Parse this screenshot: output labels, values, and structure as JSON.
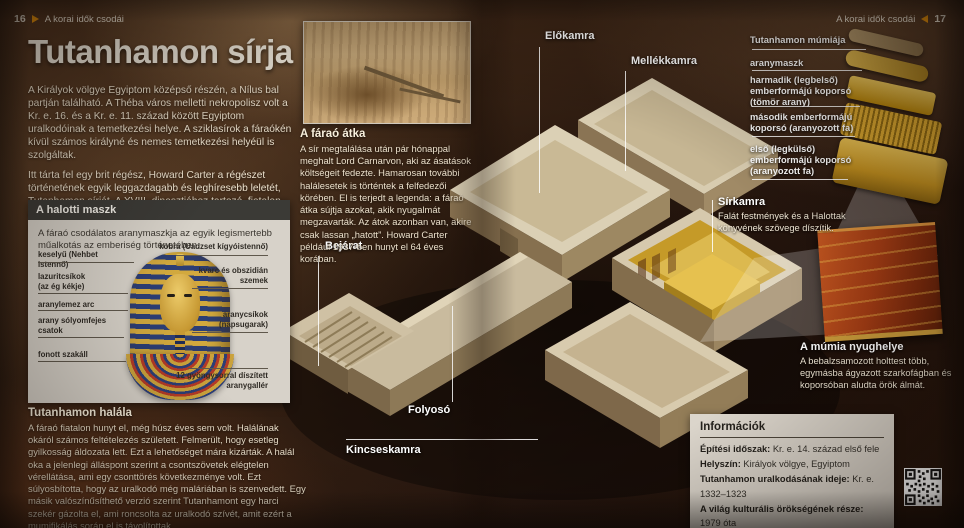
{
  "page": {
    "header_left": {
      "page_number": "16",
      "section_title": "A korai idők csodái"
    },
    "header_right": {
      "section_title": "A korai idők csodái",
      "page_number": "17"
    },
    "title": "Tutanhamon sírja",
    "intro_paragraphs": {
      "p1": "A Királyok völgye Egyiptom középső részén, a Nílus bal partján található. A Théba város melletti nekropolisz volt a Kr. e. 16. és a Kr. e. 11. század között Egyiptom uralkodóinak a temetkezési helye. A sziklasírok a fáraókén kívül számos királyné és nemes temetkezési helyéül is szolgáltak.",
      "p2": "Itt tárta fel egy brit régész, Howard Carter a régészet történetének egyik leggazdagabb és leghíresebb leletét, Tutanhamon sírját. A XVIII. dinasztiához tartozó, fiatalon elhunyt fáraó nyughelye máig az egyetlen, épségben megmaradt fáraósír."
    }
  },
  "mask_box": {
    "title": "A halotti maszk",
    "description": "A fáraó csodálatos aranymaszkja az egyik legismertebb műalkotás az emberiség történetében.",
    "labels": {
      "vulture": "keselyű (Nehbet istennő)",
      "lapis": "lazuritcsíkok (az ég kékje)",
      "gold_face": "aranylemez arc",
      "falcon_clasps": "arany sólyomfejes csatok",
      "braided_beard": "fonott szakáll",
      "cobra": "kobra (Uadzset kígyóistennő)",
      "eyes": "kvarc és obszidián szemek",
      "gold_stripes": "aranycsíkok (napsugarak)",
      "collar": "12 gyöngysorral díszített aranygallér"
    }
  },
  "death_section": {
    "title": "Tutanhamon halála",
    "text": "A fáraó fiatalon hunyt el, még húsz éves sem volt. Halálának okáról számos feltételezés született. Felmerült, hogy esetleg gyilkosság áldozata lett. Ezt a lehetőséget mára kizárták. A halál oka a jelenlegi álláspont szerint a csontszövetek elégtelen vérellátása, ami egy csonttörés következménye volt. Ezt súlyosbította, hogy az uralkodó még maláriában is szenvedett. Egy másik valószínűsíthető verzió szerint Tutanhamont egy harci szekér gázolta el, ami roncsolta az uralkodó szívét, amit ezért a mumifikálás során el is távolítottak."
  },
  "curse_section": {
    "title": "A fáraó átka",
    "text": "A sír megtalálása után pár hónappal meghalt Lord Carnarvon, aki az ásatások költségeit fedezte. Hamarosan további halálesetek is történtek a felfedezői körében. El is terjedt a legenda: a fáraó átka sújtja azokat, akik nyugalmát megzavarták. Az átok azonban van, akire csak lassan „hatott”. Howard Carter például 1937-ben hunyt el 64 éves korában."
  },
  "diagram": {
    "chambers": {
      "entrance": "Bejárat",
      "corridor": "Folyosó",
      "antechamber": "Előkamra",
      "annex": "Mellékkamra",
      "treasury": "Kincseskamra"
    },
    "burial_chamber": {
      "title": "Sírkamra",
      "text": "Falát festmények és a Halottak könyvének szövege díszítik."
    },
    "coffin_stack": {
      "mummy": "Tutanhamon múmiája",
      "mask": "aranymaszk",
      "third_coffin": "harmadik (legbelső) emberformájú koporsó (tömör arany)",
      "second_coffin": "második emberformájú koporsó (aranyozott fa)",
      "first_coffin": "első (legkülső) emberformájú koporsó (aranyozott fa)"
    },
    "resting_place": {
      "title": "A múmia nyughelye",
      "text": "A bebalzsamozott holttest több, egymásba ágyazott szarkofágban és koporsóban aludta örök álmát."
    }
  },
  "info_box": {
    "title": "Információk",
    "rows": [
      {
        "label": "Építési időszak:",
        "value": "Kr. e. 14. század első fele"
      },
      {
        "label": "Helyszín:",
        "value": "Királyok völgye, Egyiptom"
      },
      {
        "label": "Tutanhamon uralkodásának ideje:",
        "value": "Kr. e. 1332–1323"
      },
      {
        "label": "A világ kulturális örökségének része:",
        "value": "1979 óta"
      }
    ]
  },
  "colors": {
    "accent_orange": "#e8920a",
    "page_background": "#3a2415",
    "box_background": "#d7d2c9",
    "gold": "#d4af37",
    "shrine_red": "#a33c14"
  }
}
